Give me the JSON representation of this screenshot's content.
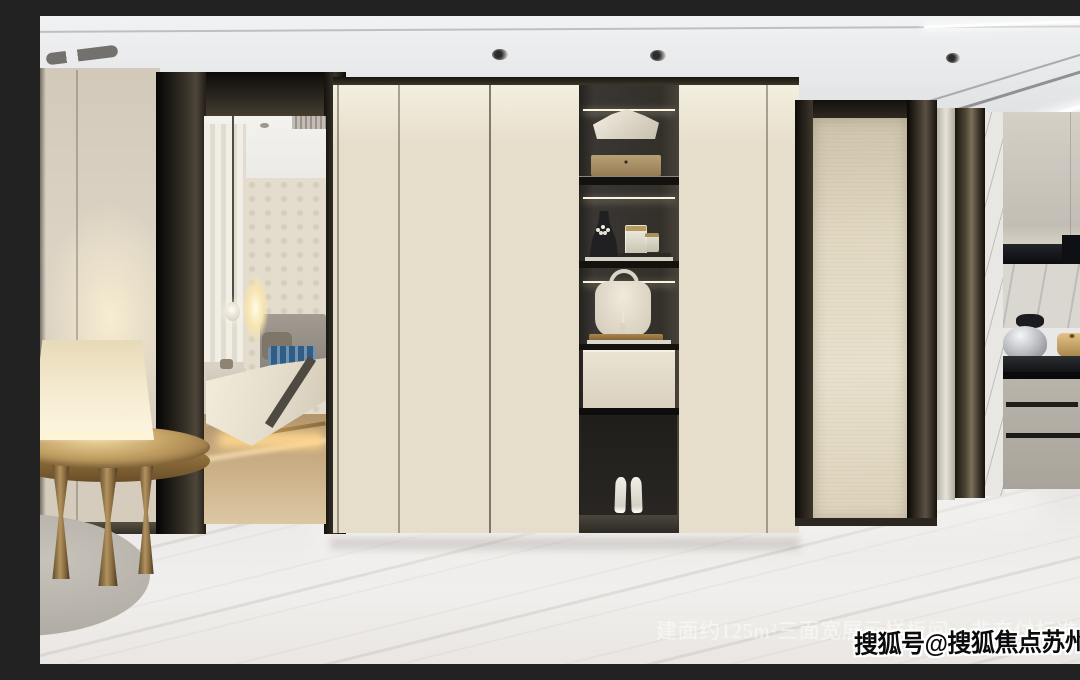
{
  "watermarks": {
    "caption": "建面约125m²三面宽展示样板间，非交付标准",
    "badge": "搜狐号@搜狐焦点苏州站"
  },
  "colors": {
    "wardrobe_cream": "#e6decb",
    "bronze_trim": "#4a4236",
    "warm_glow": "#f6ecd0",
    "marble_floor": "#edebe9",
    "kitchen_counter_black": "#141416",
    "kitchen_cabinet_greige": "#b8b4ab",
    "accent_gold": "#c3a165",
    "bedroom_floor_tan": "#c9ad84",
    "badge_text": "#0b0b0b",
    "badge_outline": "#ffffff"
  }
}
